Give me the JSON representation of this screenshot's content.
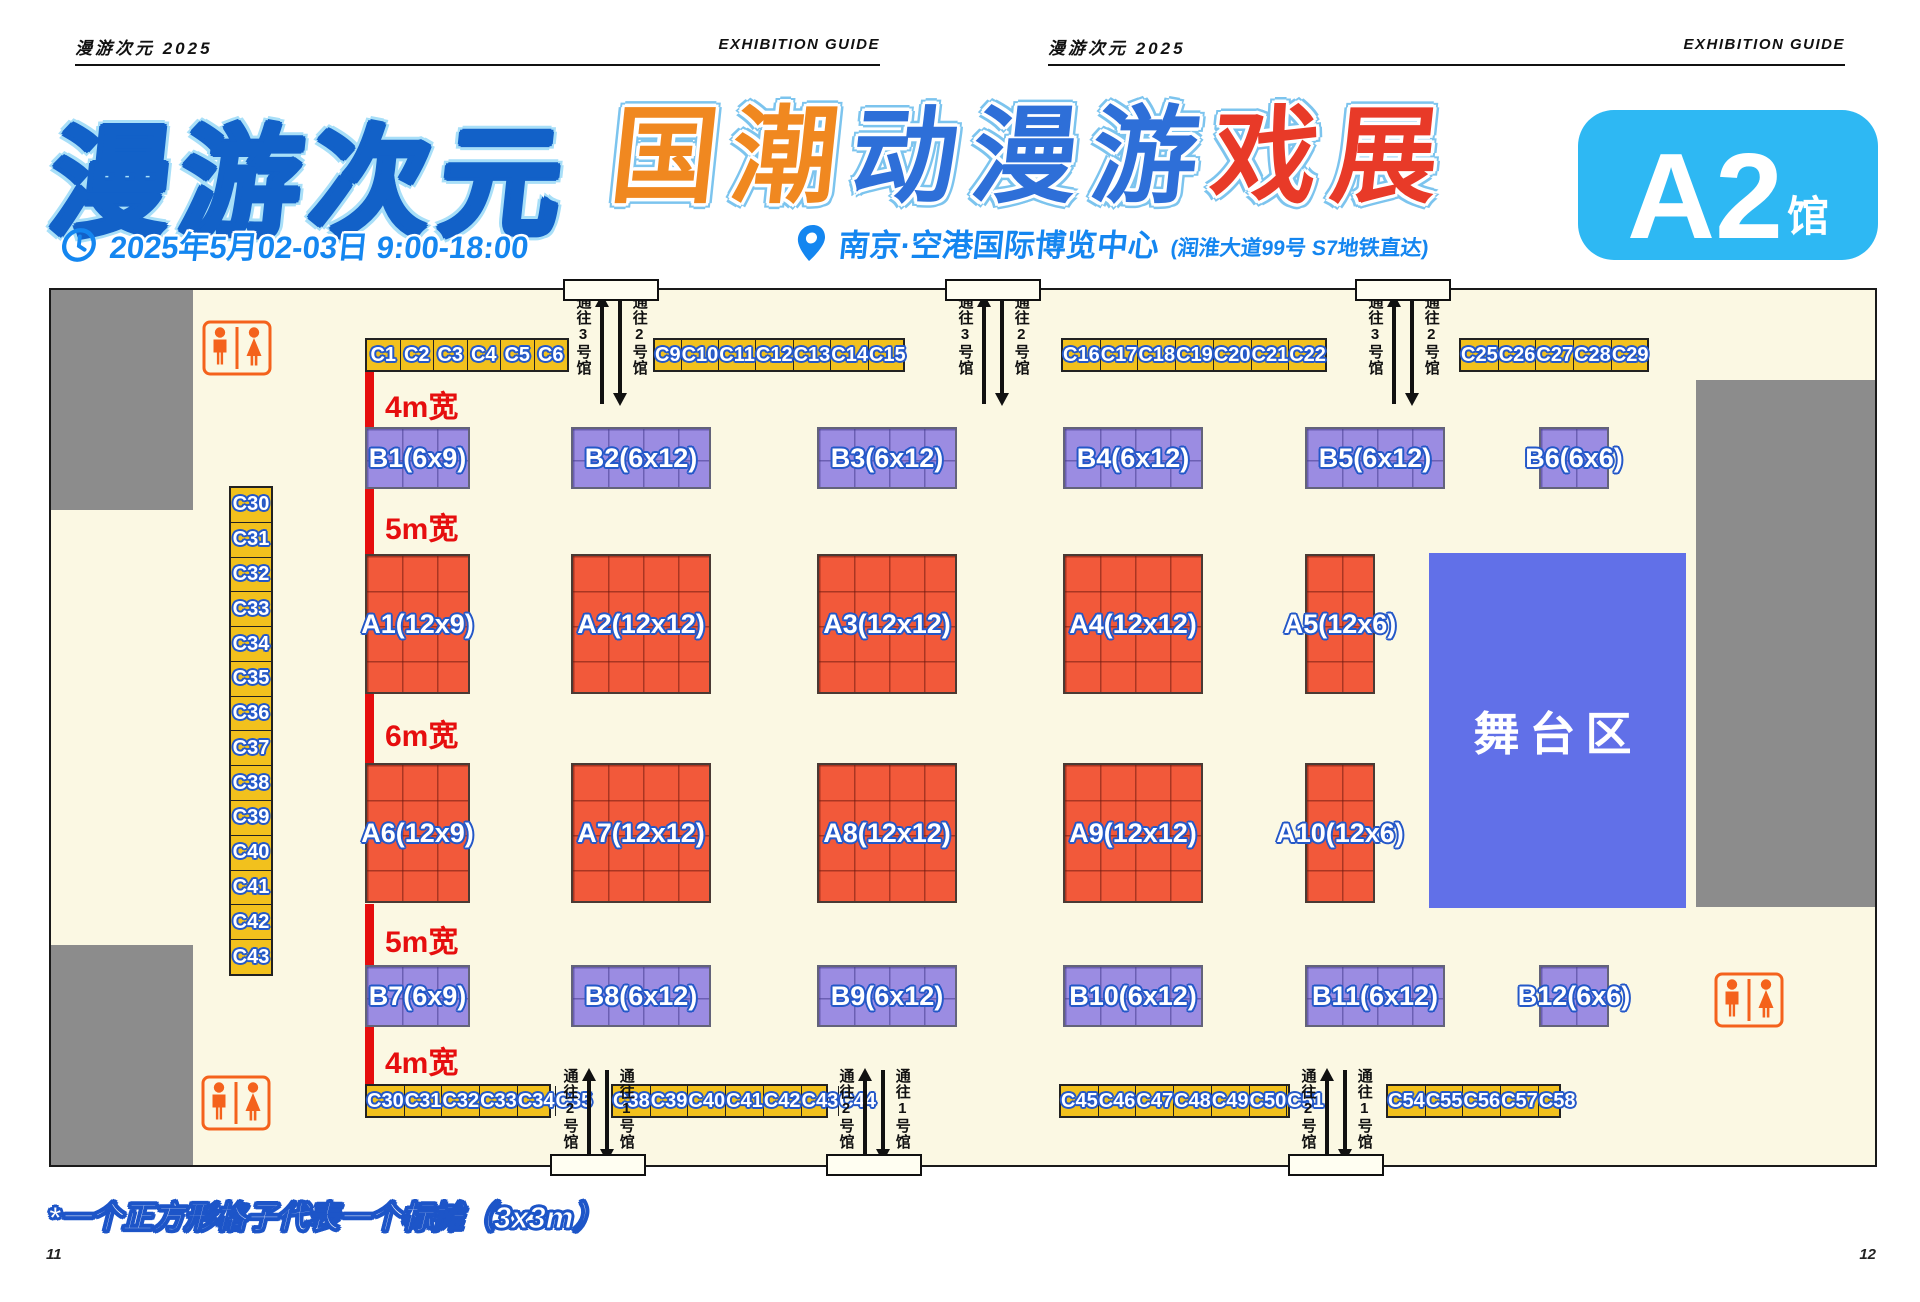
{
  "page_header": {
    "left": {
      "brand": "漫游次元 2025",
      "guide": "EXHIBITION GUIDE"
    },
    "right": {
      "brand": "漫游次元 2025",
      "guide": "EXHIBITION GUIDE"
    }
  },
  "title": {
    "main_text": "漫游次元",
    "sub": {
      "text": "国潮动漫游戏展",
      "char_colors": [
        "#F08820",
        "#F08820",
        "#2E6FD8",
        "#2E6FD8",
        "#2E6FD8",
        "#E83A28",
        "#E83A28"
      ]
    },
    "datetime": "2025年5月02-03日  9:00-18:00",
    "venue": "南京·空港国际博览中心",
    "venue_note": "(润淮大道99号  S7地铁直达)",
    "hall_badge": {
      "main": "A2",
      "suffix": "馆",
      "bg": "#2EB8F3"
    }
  },
  "icons": {
    "datetime": "clock-icon",
    "venue": "location-pin-icon",
    "restroom": "male-female-restroom-icon"
  },
  "plan": {
    "stage_label": "舞台区",
    "aisles": [
      "4m宽",
      "5m宽",
      "6m宽",
      "5m宽",
      "4m宽"
    ],
    "b_row1": [
      "B1(6x9)",
      "B2(6x12)",
      "B3(6x12)",
      "B4(6x12)",
      "B5(6x12)",
      "B6(6x6)"
    ],
    "a_row1": [
      "A1(12x9)",
      "A2(12x12)",
      "A3(12x12)",
      "A4(12x12)",
      "A5(12x6)"
    ],
    "a_row2": [
      "A6(12x9)",
      "A7(12x12)",
      "A8(12x12)",
      "A9(12x12)",
      "A10(12x6)"
    ],
    "b_row2": [
      "B7(6x9)",
      "B8(6x12)",
      "B9(6x12)",
      "B10(6x12)",
      "B11(6x12)",
      "B12(6x6)"
    ],
    "c_top_groups": [
      [
        "C1",
        "C2",
        "C3",
        "C4",
        "C5",
        "C6"
      ],
      [
        "C9",
        "C10",
        "C11",
        "C12",
        "C13",
        "C14",
        "C15"
      ],
      [
        "C16",
        "C17",
        "C18",
        "C19",
        "C20",
        "C21",
        "C22"
      ],
      [
        "C25",
        "C26",
        "C27",
        "C28",
        "C29"
      ]
    ],
    "c_left_column": [
      "C30",
      "C31",
      "C32",
      "C33",
      "C34",
      "C35",
      "C36",
      "C37",
      "C38",
      "C39",
      "C40",
      "C41",
      "C42",
      "C43"
    ],
    "c_bottom_groups": [
      [
        "C30",
        "C31",
        "C32",
        "C33",
        "C34",
        "C35"
      ],
      [
        "C38",
        "C39",
        "C40",
        "C41",
        "C42",
        "C43",
        "C44"
      ],
      [
        "C45",
        "C46",
        "C47",
        "C48",
        "C49",
        "C50",
        "C51"
      ],
      [
        "C54",
        "C55",
        "C56",
        "C57",
        "C58"
      ]
    ],
    "corridors_top": [
      {
        "left_label": "通往3号馆",
        "right_label": "通往2号馆"
      },
      {
        "left_label": "通往3号馆",
        "right_label": "通往2号馆"
      },
      {
        "left_label": "通往3号馆",
        "right_label": "通往2号馆"
      }
    ],
    "corridors_bottom": [
      {
        "left_label": "通往2号馆",
        "right_label": "通往1号馆"
      },
      {
        "left_label": "通往2号馆",
        "right_label": "通往1号馆"
      },
      {
        "left_label": "通往2号馆",
        "right_label": "通往1号馆"
      }
    ]
  },
  "legend_note": "*一个正方形格子代表一个标摊（3x3m）",
  "page_numbers": {
    "left": "11",
    "right": "12"
  },
  "colors": {
    "plan_background": "#FBF8E3",
    "booth_a": "#F2593A",
    "booth_b": "#9B8CE2",
    "booth_c": "#F2C11D",
    "stage": "#6170E8",
    "wall_gray": "#8C8C8C",
    "aisle_red": "#E60E0E",
    "info_blue": "#1486F0",
    "badge_blue": "#2EB8F3",
    "label_outline_blue": "#2458C8",
    "restroom_orange": "#F4621C"
  }
}
